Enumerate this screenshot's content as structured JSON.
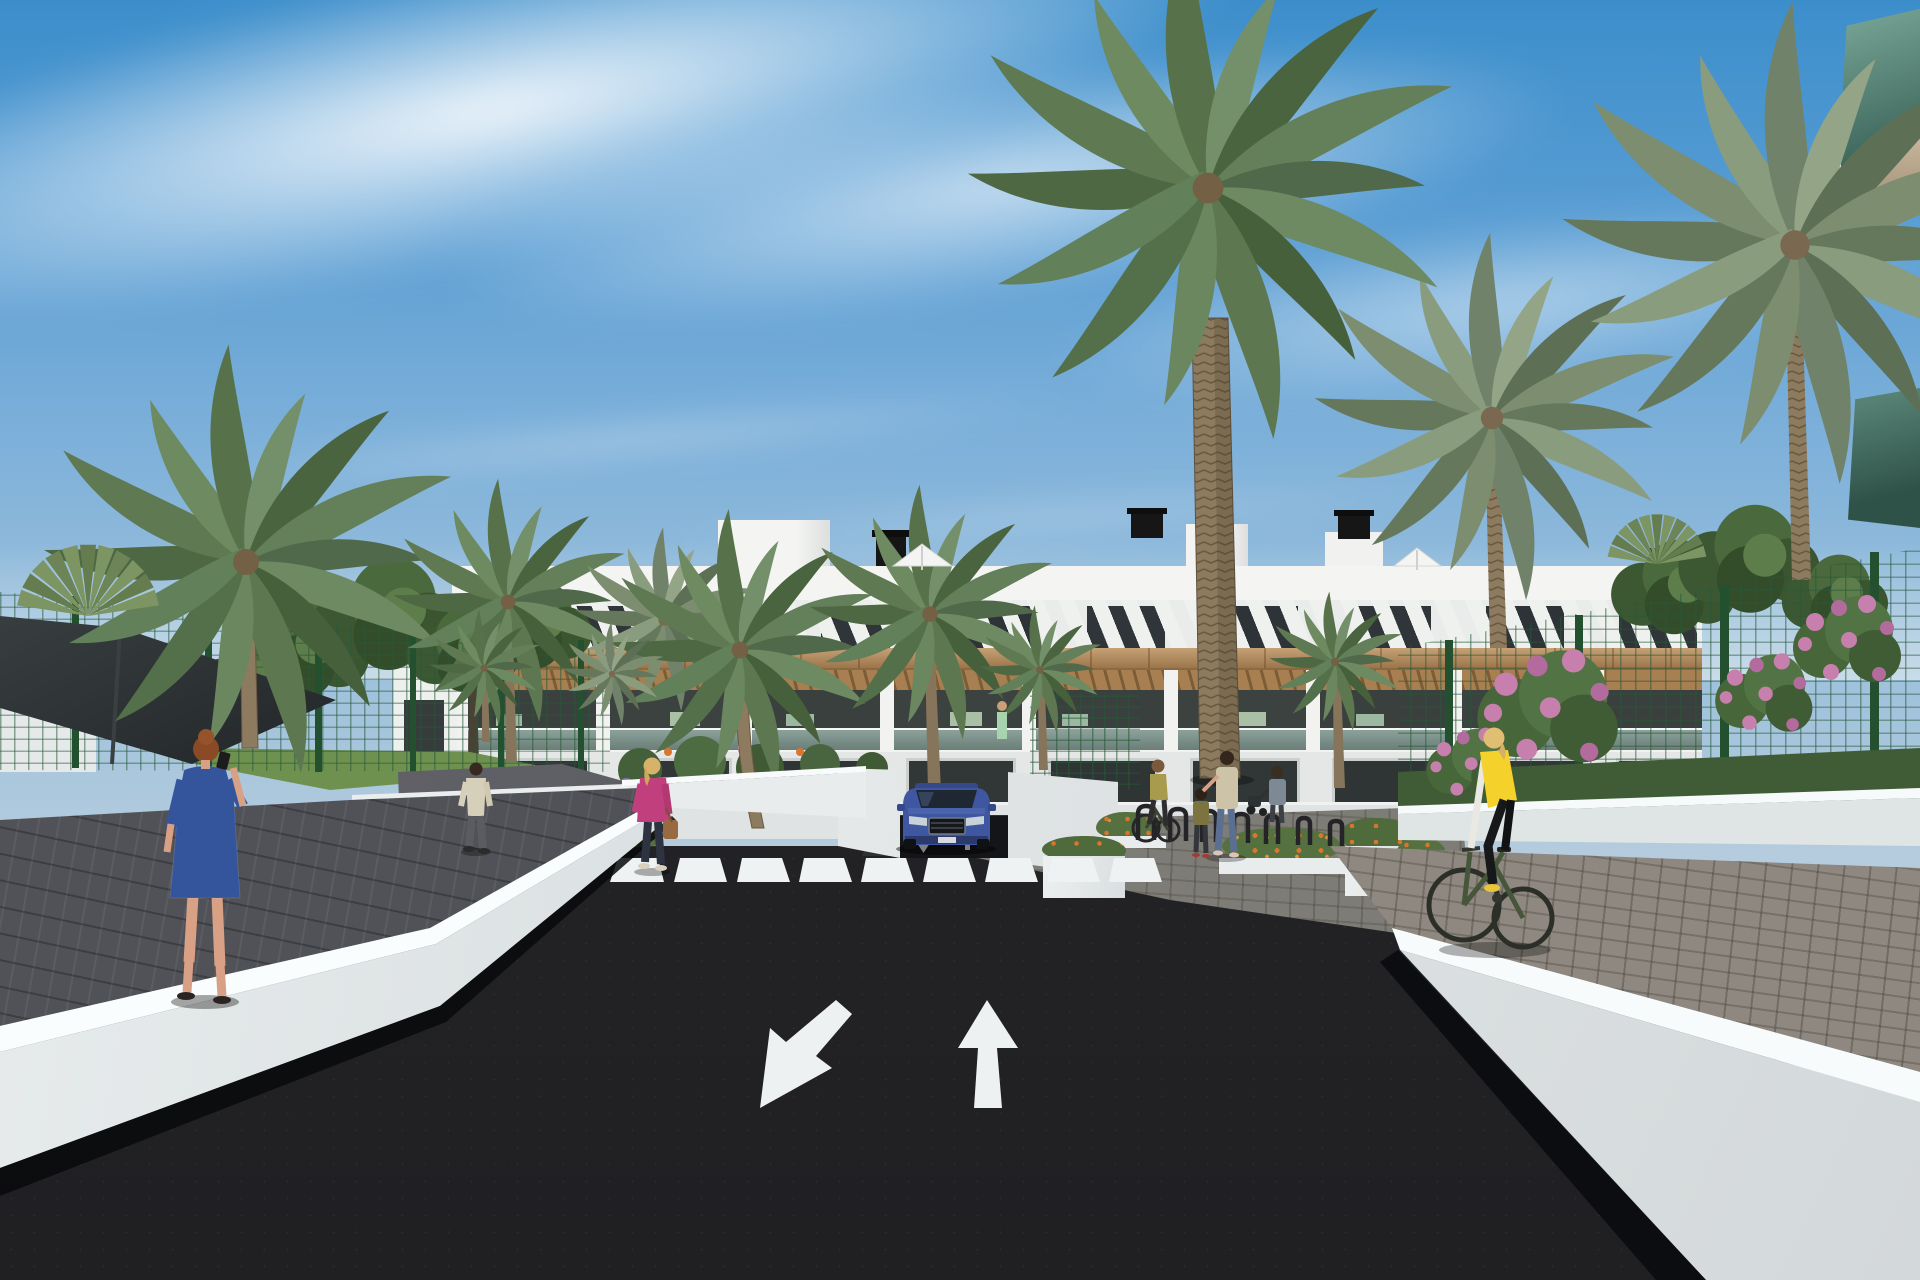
{
  "image": {
    "kind": "architectural_rendering",
    "width": 1920,
    "height": 1280,
    "summary": "Photorealistic 3D rendering of a modern white residential apartment complex with palm-lined landscaping, a dark asphalt access road with painted lane arrows and a zebra crosswalk, a blue SUV exiting an underground car park, pedestrians and a cyclist."
  },
  "palette": {
    "sky_top": "#3c8ecb",
    "sky_horizon": "#c9d5de",
    "cloud_white": "#ffffff",
    "building_white": "#f1f2f0",
    "wood_accent": "#b3885a",
    "window_glass": "#31363a",
    "balcony_glass": "#6fa191",
    "palm_green": "#5d7850",
    "palm_gray_green": "#7c8e6f",
    "palm_trunk": "#8d7b5f",
    "leaf_tree_green": "#45653a",
    "fence_green": "#23502f",
    "shade_sail": "#2a2f31",
    "asphalt": "#242427",
    "road_marking_white": "#eff2f2",
    "wall_white": "#e9edee",
    "curb_white": "#fafdfe",
    "paver_gray": "#8e8880",
    "walkway_dark": "#515257",
    "car_blue": "#3f57a0",
    "flower_orange": "#d9752c",
    "flower_pink": "#c77fae",
    "flower_purple": "#9a7fb5",
    "dress_blue": "#34549c",
    "jacket_pink": "#c13f7d",
    "vest_yellow": "#f4d22b"
  },
  "scene": {
    "sky": {
      "description": "Blue sky with diagonal wispy cirrus cloud bands"
    },
    "buildings": [
      {
        "name": "main-apartment-block",
        "style": "modern white render with timber accents",
        "floors": 3,
        "features": [
          "rooftop terraces",
          "black chimneys",
          "white parasols",
          "diagonal pergola slats",
          "timber fascia band",
          "glass balustrade balconies",
          "covered ground terraces"
        ]
      },
      {
        "name": "foreground-balcony-corner",
        "style": "white slab with tinted green glass balustrade",
        "position": "top right nearest camera"
      }
    ],
    "road": {
      "surface": "dark asphalt",
      "markings": {
        "lane_arrows": [
          {
            "direction": "toward viewer (down-left)"
          },
          {
            "direction": "away from viewer (up)"
          }
        ],
        "crosswalk": {
          "stripes": 9,
          "color": "white"
        },
        "ramp_arrows": 2
      },
      "features": [
        "underground parking ramp",
        "white retaining walls",
        "bright white curb edges"
      ]
    },
    "vehicles": [
      {
        "type": "SUV",
        "color": "blue",
        "state": "exiting underground car park toward the crosswalk"
      }
    ],
    "people": [
      {
        "id": "woman-blue-dress",
        "description": "Red-haired woman in a blue patterned dress walking on the left walkway while talking on the phone"
      },
      {
        "id": "man-path",
        "description": "Man in a light shirt and gray trousers walking up the garden path"
      },
      {
        "id": "woman-pink-jacket",
        "description": "Blonde woman in a pink jacket with a brown handbag crossing the garden path"
      },
      {
        "id": "cyclist-yellow-vest",
        "description": "Blonde woman in a yellow gilet riding a dark green bicycle away on the right walkway"
      },
      {
        "id": "woman-bicycle-plaza",
        "description": "Woman in an olive top on a bicycle by the bike racks"
      },
      {
        "id": "mother-and-child",
        "description": "Mother in a floral top and jeans with her hand on a child's head"
      },
      {
        "id": "person-stroller",
        "description": "Person in a gray-blue top pushing a stroller"
      },
      {
        "id": "resident-balcony",
        "description": "Small figure in a green dress standing on a first-floor balcony"
      }
    ],
    "vegetation": {
      "palms": "tall date palms and small fan palms",
      "trees": "leafy green trees behind the left fence",
      "flowers": [
        "orange ground flowers in planters",
        "pink flowering shrubs on the right",
        "purple flower spikes by the path"
      ],
      "hedges": "low green hedge along the right fence"
    },
    "structures": [
      "dark shade sail on the left",
      "green mesh perimeter fences",
      "white planter walls",
      "bicycle racks",
      "white retaining walls with paver walkways"
    ]
  }
}
